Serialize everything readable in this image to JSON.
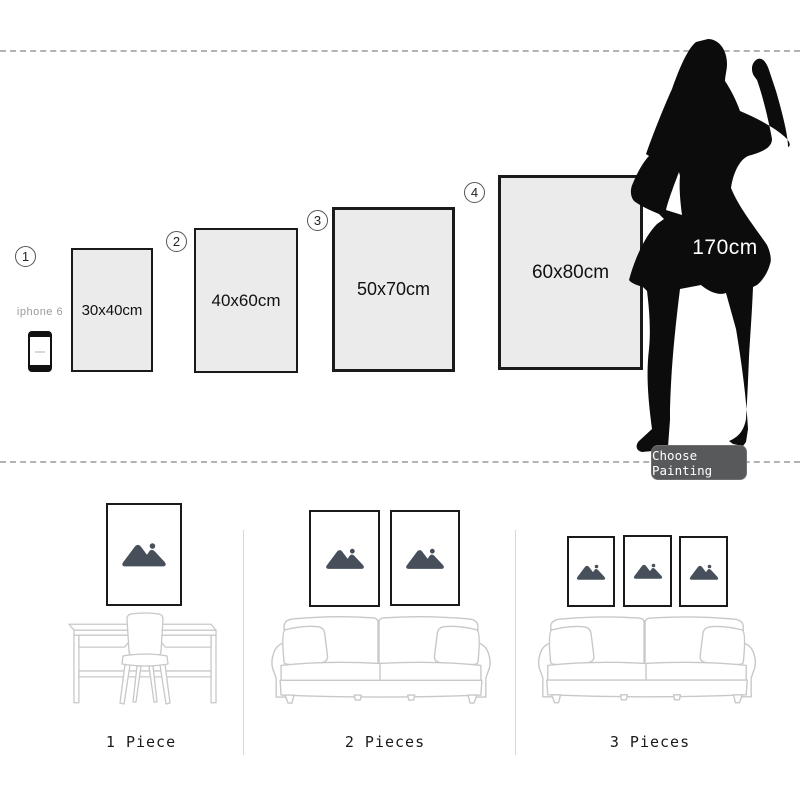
{
  "size_chart": {
    "steps": [
      {
        "number": "1",
        "size_label": "30x40cm"
      },
      {
        "number": "2",
        "size_label": "40x60cm"
      },
      {
        "number": "3",
        "size_label": "50x70cm"
      },
      {
        "number": "4",
        "size_label": "60x80cm"
      }
    ],
    "phone_label": "iphone 6",
    "person_height_label": "170cm",
    "choose_button_label": "Choose Painting"
  },
  "rooms": [
    {
      "label": "1 Piece"
    },
    {
      "label": "2 Pieces"
    },
    {
      "label": "3 Pieces"
    }
  ],
  "colors": {
    "frame_fill": "#ebebeb",
    "frame_border": "#1a1a1a",
    "silhouette": "#0c0c0c",
    "button_bg": "#58595b",
    "furniture_line": "#c8c8c8",
    "placeholder_icon": "#47505a",
    "dash_line": "#b3b3b3"
  }
}
